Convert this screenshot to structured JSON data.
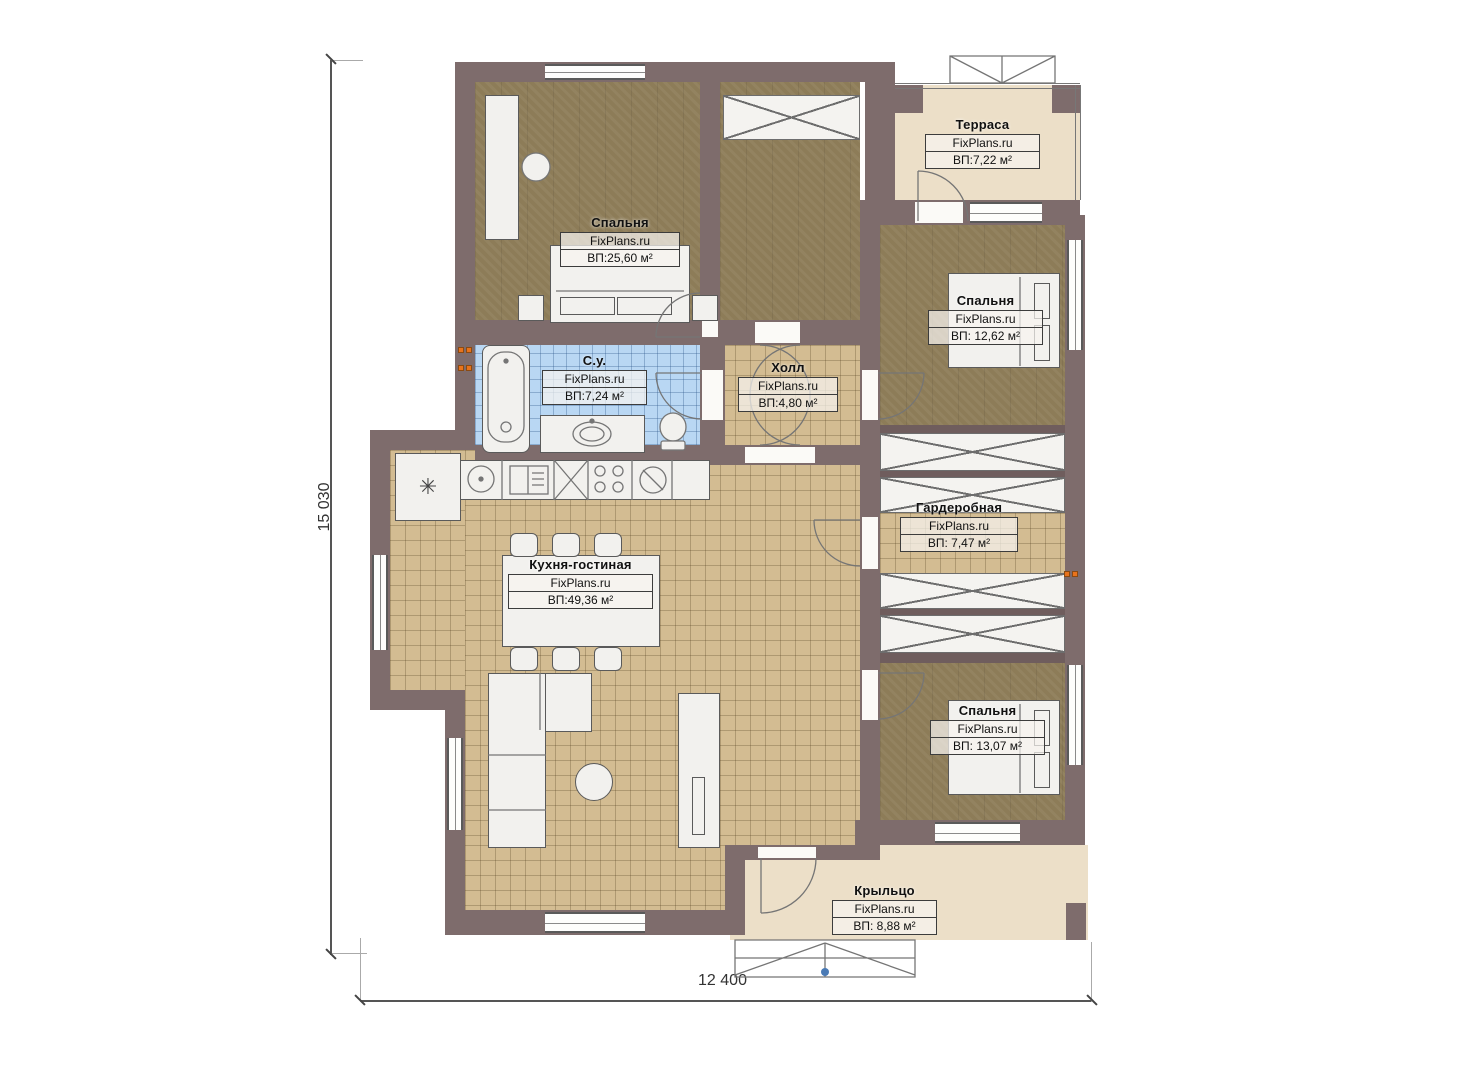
{
  "meta": {
    "type": "floor-plan",
    "floor_description": "one-storey house plan"
  },
  "dimensions": {
    "height_total": "15 030",
    "width_total": "12 400"
  },
  "rooms": [
    {
      "id": "bedroom-1",
      "name": "Спальня",
      "brand": "FixPlans.ru",
      "area": "ВП:25,60 м²"
    },
    {
      "id": "terrace",
      "name": "Терраса",
      "brand": "FixPlans.ru",
      "area": "ВП:7,22 м²"
    },
    {
      "id": "bedroom-2",
      "name": "Спальня",
      "brand": "FixPlans.ru",
      "area": "ВП: 12,62 м²"
    },
    {
      "id": "bathroom",
      "name": "С.у.",
      "brand": "FixPlans.ru",
      "area": "ВП:7,24 м²"
    },
    {
      "id": "hall",
      "name": "Холл",
      "brand": "FixPlans.ru",
      "area": "ВП:4,80 м²"
    },
    {
      "id": "wardrobe",
      "name": "Гардеробная",
      "brand": "FixPlans.ru",
      "area": "ВП: 7,47 м²"
    },
    {
      "id": "kitchen-living",
      "name": "Кухня-гостиная",
      "brand": "FixPlans.ru",
      "area": "ВП:49,36 м²"
    },
    {
      "id": "bedroom-3",
      "name": "Спальня",
      "brand": "FixPlans.ru",
      "area": "ВП: 13,07 м²"
    },
    {
      "id": "porch",
      "name": "Крыльцо",
      "brand": "FixPlans.ru",
      "area": "ВП: 8,88 м²"
    }
  ],
  "icons": {
    "boiler": "✳"
  },
  "colors": {
    "wall": "#7e6c6c",
    "bedroom_floor": "#8d7c58",
    "tile_floor": "#d3bc92",
    "bath_tile": "#b9d7f3",
    "terrace_floor": "#ecdfc8",
    "radiator": "#e8731c",
    "step_marker": "#4a7ab5"
  }
}
